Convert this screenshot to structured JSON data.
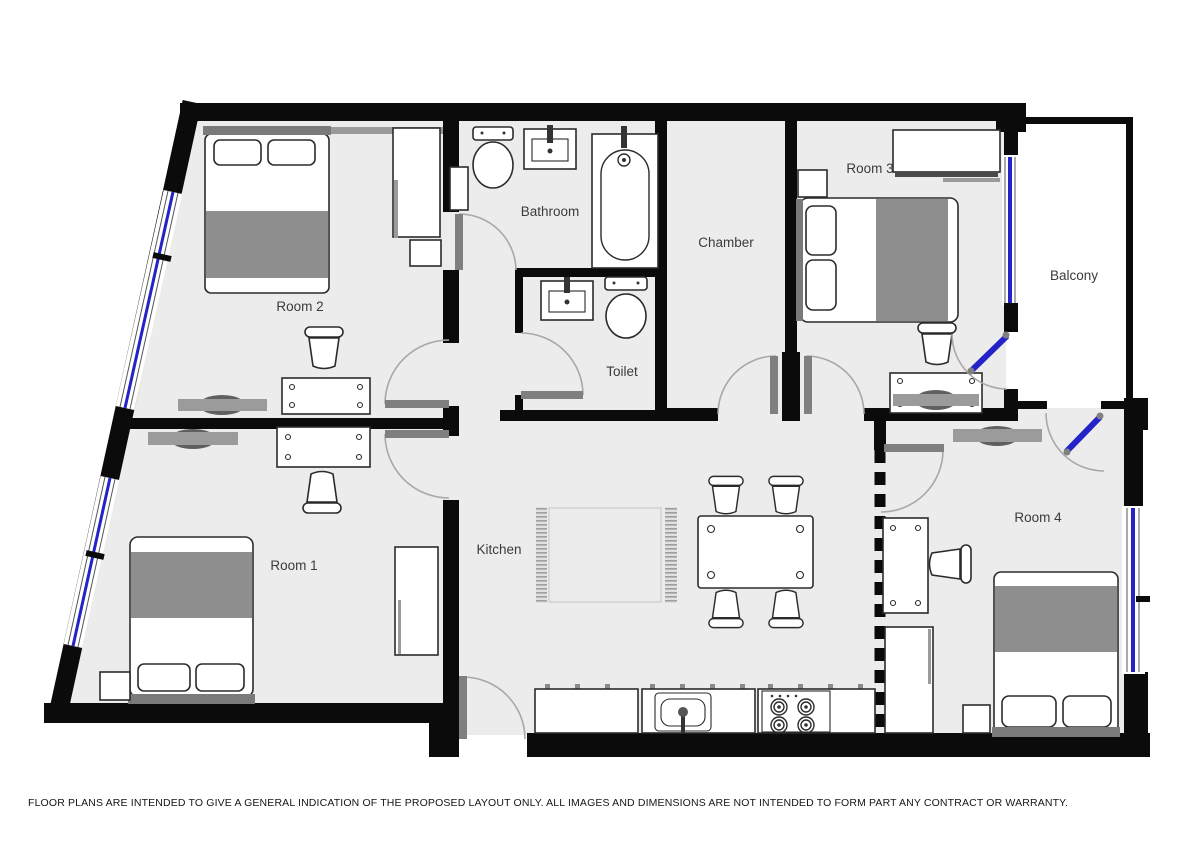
{
  "floorplan": {
    "labels": {
      "room1": "Room 1",
      "room2": "Room 2",
      "room3": "Room 3",
      "room4": "Room 4",
      "bathroom": "Bathroom",
      "toilet": "Toilet",
      "chamber": "Chamber",
      "kitchen": "Kitchen",
      "balcony": "Balcony"
    },
    "colors": {
      "wall": "#0b0b0b",
      "floor": "#ececec",
      "balcony_floor": "#ffffff",
      "window": "#2323c8",
      "furniture_fill": "#ffffff",
      "furniture_stroke": "#2b2b2b",
      "textile_gray": "#8e8e8e",
      "shelf_gray": "#9b9b9b",
      "door_leaf": "#7f7f7f",
      "arc": "#a8a8a8"
    },
    "disclaimer": "FLOOR PLANS ARE INTENDED TO GIVE A GENERAL INDICATION OF THE PROPOSED LAYOUT ONLY. ALL IMAGES AND DIMENSIONS ARE NOT INTENDED TO FORM PART ANY CONTRACT OR WARRANTY."
  }
}
